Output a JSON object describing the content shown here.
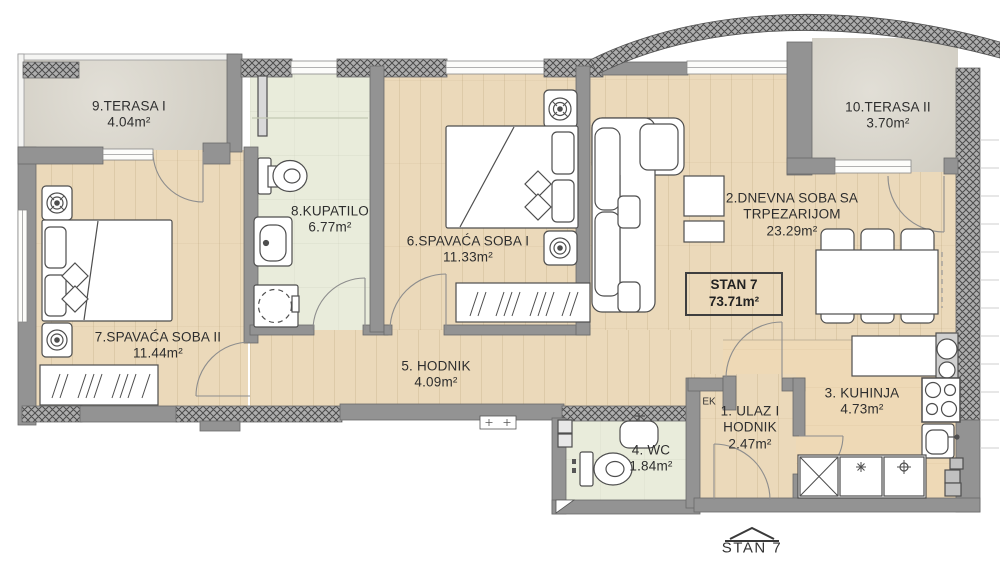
{
  "unit": {
    "box_name": "STAN 7",
    "box_area": "73.71m²",
    "footer_label": "STAN 7"
  },
  "annotations": {
    "electrical_cabinet": "EK"
  },
  "rooms": {
    "ulaz": {
      "name_line1": "1. ULAZ I",
      "name_line2": "HODNIK",
      "area": "2.47m²"
    },
    "dnevna": {
      "name_line1": "2.DNEVNA SOBA SA",
      "name_line2": "TRPEZARIJOM",
      "area": "23.29m²"
    },
    "kuhinja": {
      "name": "3. KUHINJA",
      "area": "4.73m²"
    },
    "wc": {
      "name": "4. WC",
      "area": "1.84m²"
    },
    "hodnik": {
      "name": "5. HODNIK",
      "area": "4.09m²"
    },
    "spavaca1": {
      "name": "6.SPAVAĆA SOBA I",
      "area": "11.33m²"
    },
    "spavaca2": {
      "name": "7.SPAVAĆA SOBA II",
      "area": "11.44m²"
    },
    "kupatilo": {
      "name": "8.KUPATILO",
      "area": "6.77m²"
    },
    "terasa1": {
      "name": "9.TERASA I",
      "area": "4.04m²"
    },
    "terasa2": {
      "name": "10.TERASA II",
      "area": "3.70m²"
    }
  },
  "colors": {
    "wood_floor": "#ebd9ba",
    "tile_floor": "#e9ecdb",
    "terrace_floor": "#d8d4c9",
    "kitchen_floor": "#eed9b6",
    "wall": "#939393",
    "hatch_wall": "#aeaeae",
    "text": "#2e2e2e"
  }
}
